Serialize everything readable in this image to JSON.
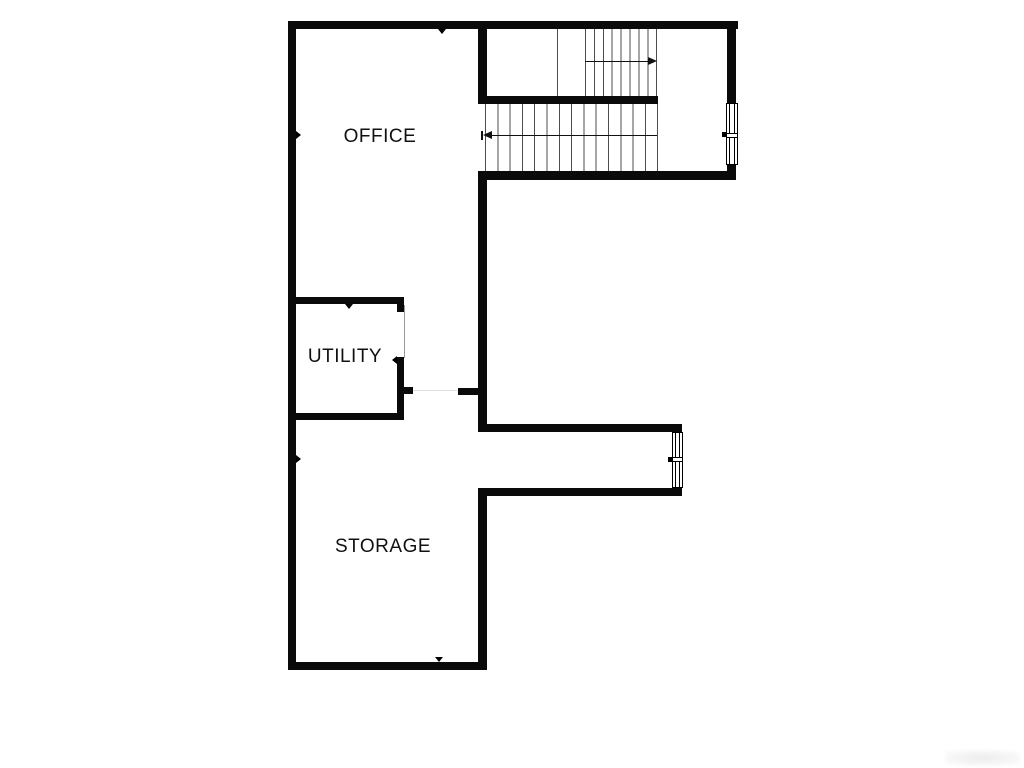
{
  "meta": {
    "type": "floor-plan",
    "width": 1024,
    "height": 768
  },
  "colors": {
    "background": "#ffffff",
    "wall": "#0a0a0a",
    "tread_line": "#4d4d4d",
    "arrow": "#111111",
    "label": "#111111",
    "door_line": "#999999",
    "watermark": "#ececec"
  },
  "rooms": [
    {
      "id": "office",
      "label": "OFFICE"
    },
    {
      "id": "utility",
      "label": "UTILITY"
    },
    {
      "id": "storage",
      "label": "STORAGE"
    }
  ],
  "stairs": {
    "lower_flight_treads": 15,
    "upper_flight_treads": 9,
    "lower_arrow_direction": "left",
    "upper_arrow_direction": "right"
  },
  "windows": [
    {
      "id": "stair-landing-window"
    },
    {
      "id": "hall-window"
    }
  ],
  "doors": [
    {
      "id": "utility-door"
    }
  ]
}
